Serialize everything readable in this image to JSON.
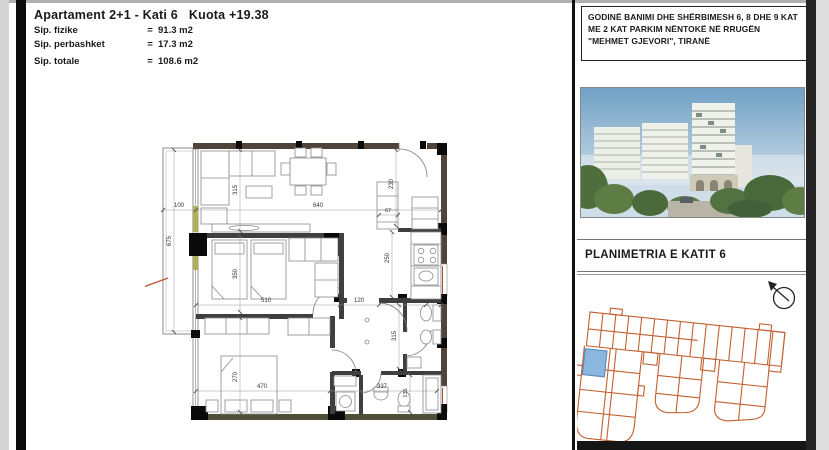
{
  "header": {
    "title": "Apartament 2+1 - Kati 6   Kuota +19.38",
    "rows": [
      {
        "label": "Sip. fizike",
        "eq": "=",
        "value": "91.3 m2"
      },
      {
        "label": "Sip. perbashket",
        "eq": "=",
        "value": "17.3 m2"
      },
      {
        "label": "Sip. totale",
        "eq": "=",
        "value": "108.6 m2"
      }
    ]
  },
  "titleblock": {
    "project": "GODINË BANIMI DHE SHËRBIMESH 6, 8 DHE 9 KAT ME 2 KAT PARKIM NËNTOKË NË RRUGËN \"MEHMET GJEVORI\", TIRANË",
    "drawing_title": "PLANIMETRIA E KATIT 6"
  },
  "plan": {
    "dims": [
      "100",
      "640",
      "315",
      "675",
      "230",
      "67",
      "250",
      "350",
      "510",
      "120",
      "167",
      "315",
      "270",
      "470",
      "337",
      "135"
    ]
  },
  "colors": {
    "keyplan_outline": "#c2602f",
    "highlight_unit": "#8ab6e0",
    "wall_dark": "#50443a"
  }
}
